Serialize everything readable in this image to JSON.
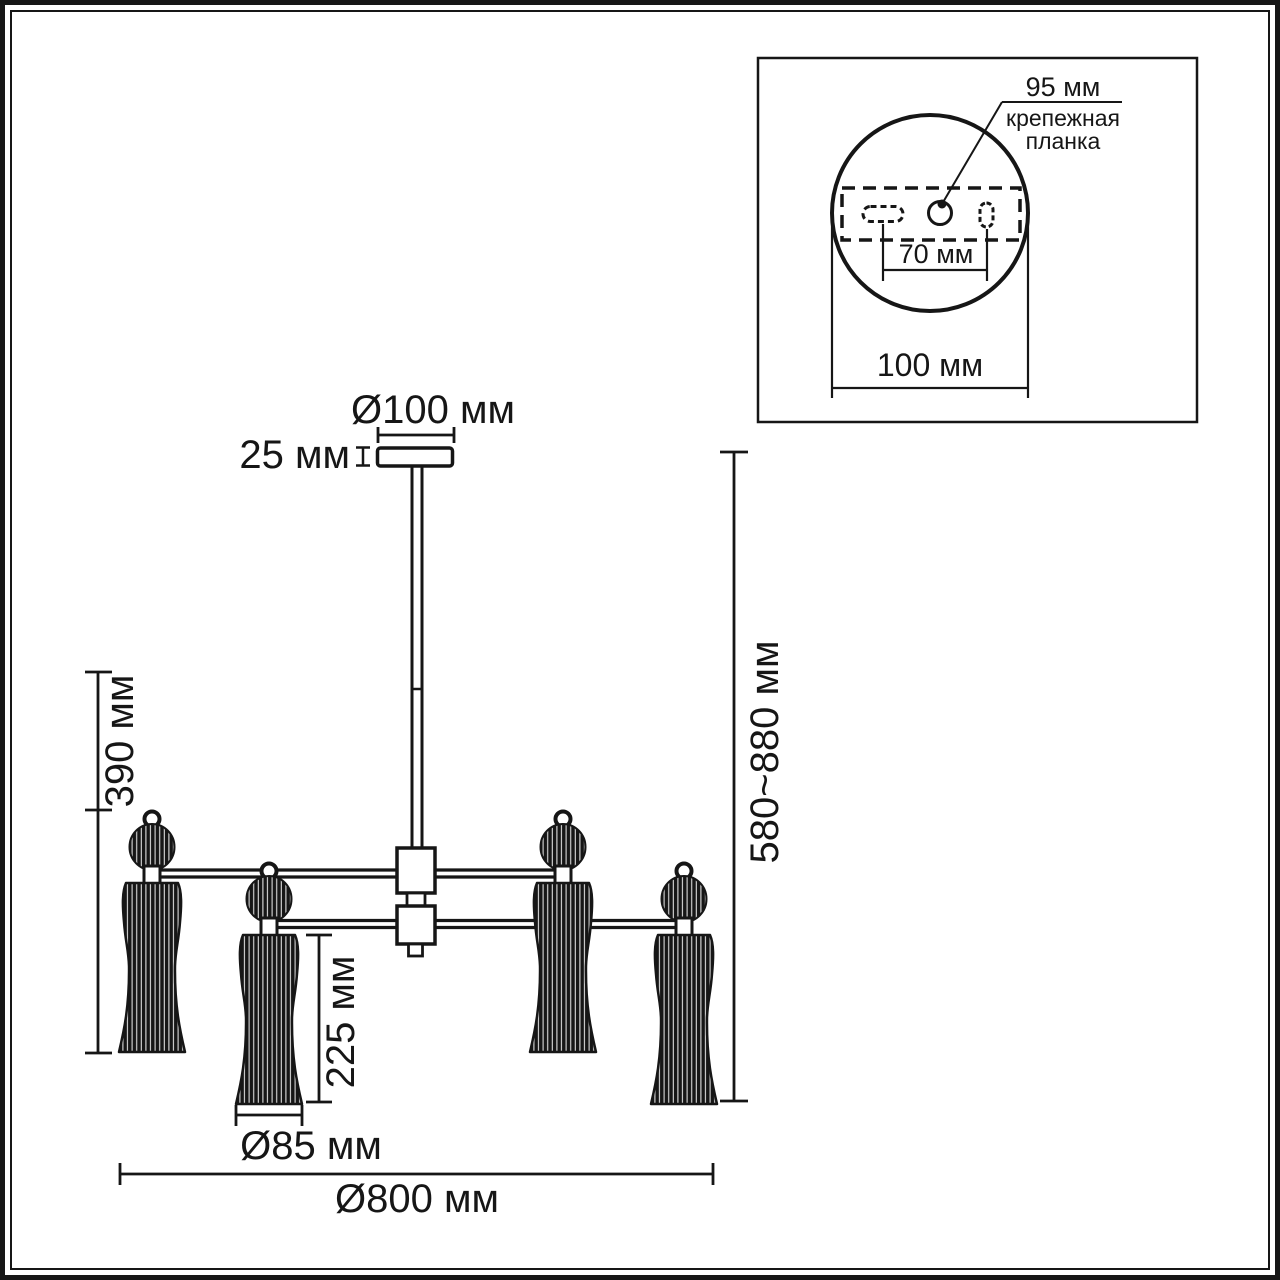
{
  "main_drawing": {
    "lamp_count": 4,
    "canopy_diameter": "Ø100 мм",
    "canopy_height": "25 мм",
    "fixture_height": "390 мм",
    "overall_height": "580~880 мм",
    "shade_height": "225 мм",
    "shade_diameter": "Ø85 мм",
    "overall_diameter": "Ø800 мм"
  },
  "inset": {
    "plate_length": "95 мм",
    "plate_name_line1": "крепежная",
    "plate_name_line2": "планка",
    "hole_spacing": "70 мм",
    "base_diameter": "100 мм"
  },
  "colors": {
    "ink": "#161616",
    "background": "#ffffff"
  }
}
